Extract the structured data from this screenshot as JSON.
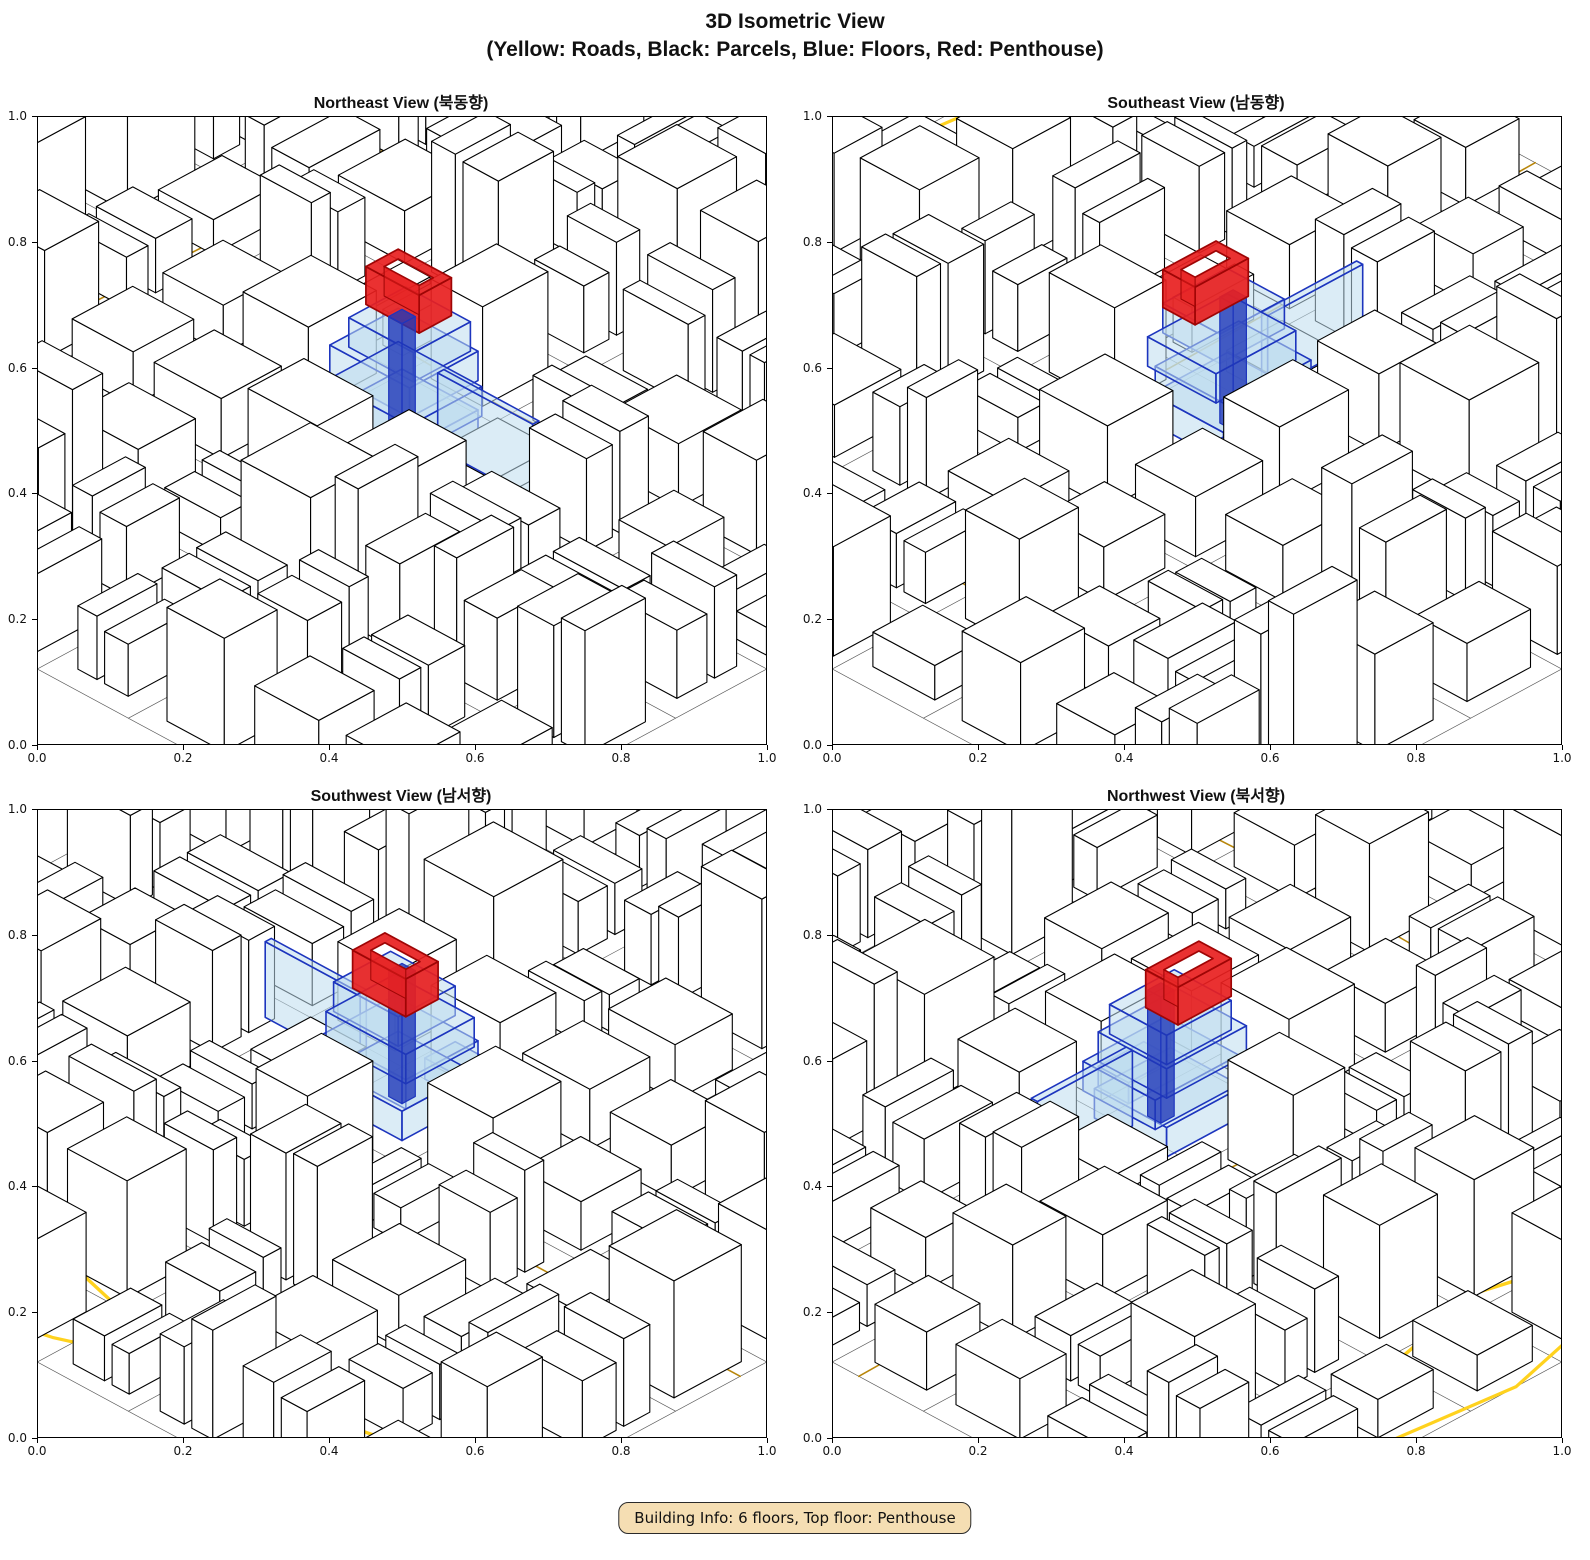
{
  "title": {
    "line1": "3D Isometric View",
    "line2": "(Yellow: Roads, Black: Parcels, Blue: Floors, Red: Penthouse)"
  },
  "subplots": [
    {
      "id": "northeast",
      "title": "Northeast View (북동향)"
    },
    {
      "id": "southeast",
      "title": "Southeast View (남동향)"
    },
    {
      "id": "southwest",
      "title": "Southwest View (남서향)"
    },
    {
      "id": "northwest",
      "title": "Northwest View (북서향)"
    }
  ],
  "axes": {
    "x_ticks": [
      "0.0",
      "0.2",
      "0.4",
      "0.6",
      "0.8",
      "1.0"
    ],
    "y_ticks": [
      "0.0",
      "0.2",
      "0.4",
      "0.6",
      "0.8",
      "1.0"
    ],
    "x_range": [
      0,
      1
    ],
    "y_range": [
      0,
      1
    ]
  },
  "colors": {
    "road_major": "#FFD21E",
    "road_minor": "#B8860B",
    "parcel_edge": "#000000",
    "building_fill": "#FFFFFF",
    "floor_fill": "#BDDCEE",
    "floor_edge": "#1D35BE",
    "floor_core": "#2038B8",
    "penthouse_fill": "#E81F1F",
    "penthouse_edge": "#9E0505",
    "badge_bg": "#F5DEB3",
    "badge_border": "#2A2A2A"
  },
  "footer": {
    "text": "Building Info: 6 floors, Top floor: Penthouse"
  }
}
